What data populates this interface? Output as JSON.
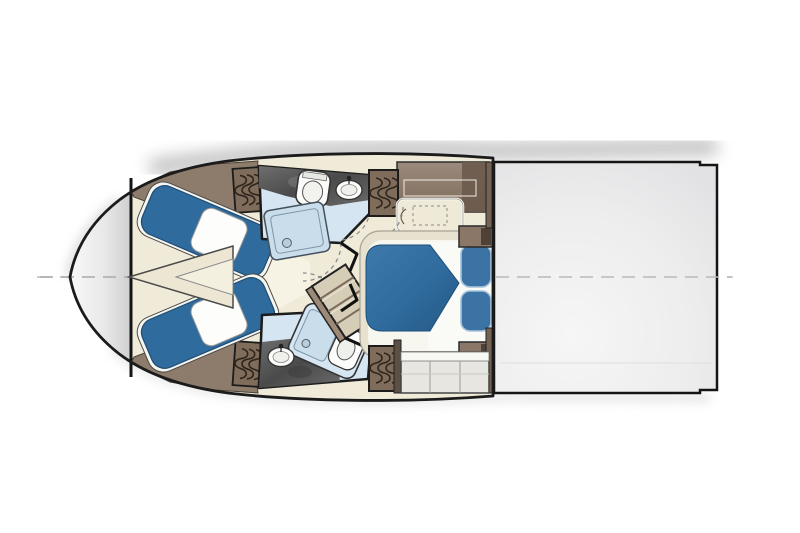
{
  "diagram": {
    "type": "yacht-floor-plan",
    "view": "overhead-lower-deck",
    "features": [
      "bow-anchor-locker",
      "v-berth-guest-cabin",
      "forward-head-with-shower",
      "aft-head-with-shower",
      "companionway-stairs",
      "master-cabin-double-berth",
      "hanging-lockers",
      "engine-room-unfurnished"
    ]
  },
  "colors": {
    "background": "#ffffff",
    "outline": "#1b1b1b",
    "centerline": "#b5b5b5",
    "hull_bow_gray": "#dedede",
    "floor_cream": "#f0ebd9",
    "aisle_cream": "#f6f2e4",
    "wall_brown": "#8d7b6b",
    "wall_brown_dark": "#6e5e50",
    "locker_brown": "#7f6c5b",
    "berth_blue": "#2f6b9d",
    "pillow_white": "#fdfdfc",
    "master_pillow_blue": "#3a73a4",
    "bedding_white": "#fafaf6",
    "platform_beige": "#e7e2cf",
    "shower_blue": "#d5e6f2",
    "shower_pan_blue": "#c9ddeb",
    "fixture_white": "#fcfcfa",
    "tile_dark": "#565656",
    "stairs_beige": "#d6cdb7",
    "cabinet_gray": "#e7e6e1",
    "engine_room_gray": "#ededee",
    "shadow_gray": "#8f8f8f",
    "triangle_filler": "#ece6d3"
  }
}
